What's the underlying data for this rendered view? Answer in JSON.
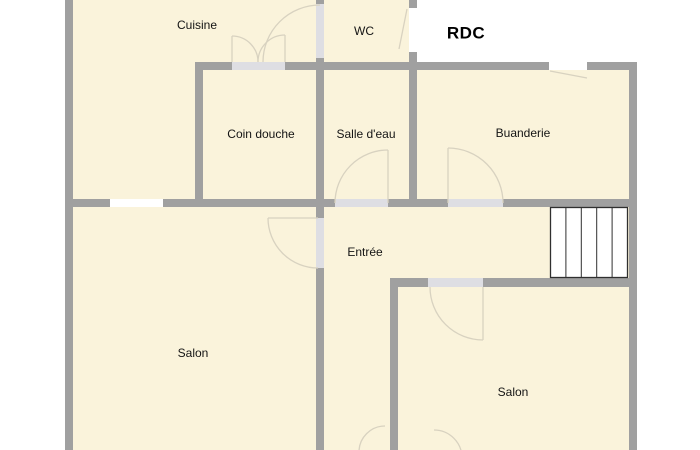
{
  "title": "RDC",
  "rooms": [
    {
      "name": "Cuisine"
    },
    {
      "name": "WC"
    },
    {
      "name": "Coin douche"
    },
    {
      "name": "Salle d'eau"
    },
    {
      "name": "Buanderie"
    },
    {
      "name": "Entrée"
    },
    {
      "name": "Salon"
    },
    {
      "name": "Salon"
    }
  ],
  "stairs": {
    "treads": 5
  },
  "colors": {
    "floor": "#FAF3DB",
    "wall": "#A0A0A0",
    "door_opening": "#DEDEE3",
    "window": "#FFFFFF",
    "door_arc": "#D8D2C0",
    "stairs_line": "#2F2F2F",
    "text": "#141414",
    "background": "#FFFFFF"
  }
}
